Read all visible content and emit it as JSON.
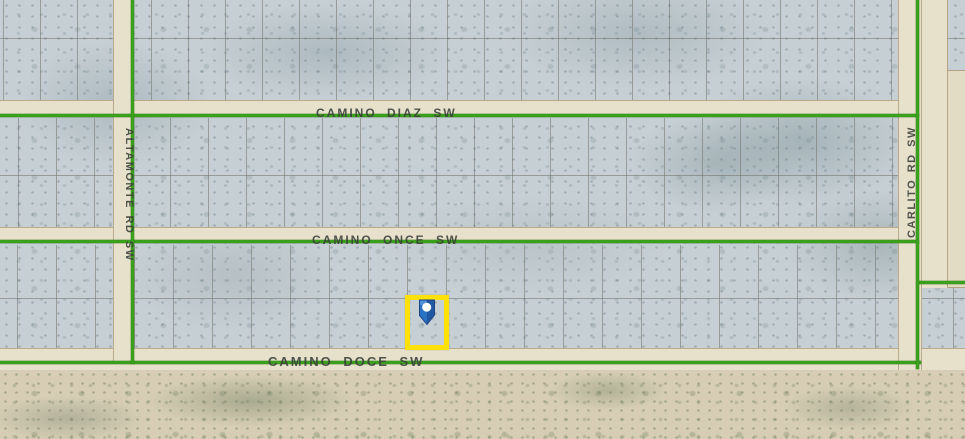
{
  "map": {
    "description": "Aerial parcel map with boundary overlay and highlighted lot marker",
    "road_labels": {
      "camino_diaz": "CAMINO DIAZ SW",
      "camino_once": "CAMINO ONCE SW",
      "camino_doce": "CAMINO DOCE SW",
      "altamonte": "ALTAMONTE RD SW",
      "carlito": "CARLITO RD SW"
    },
    "marker": {
      "type": "map-pin",
      "highlighted": true
    }
  },
  "colors": {
    "boundary_green": "#3aa01b",
    "highlight_yellow": "#ffe10a",
    "pin_blue": "#2a72c4",
    "pin_blue_dark": "#1a4386",
    "pin_dot_white": "#ffffff",
    "land_gray": "#c6cfd4",
    "road_tan": "#e7e1cb",
    "desert_tan": "#d6cdb4",
    "label_text": "#3a3f3a"
  }
}
